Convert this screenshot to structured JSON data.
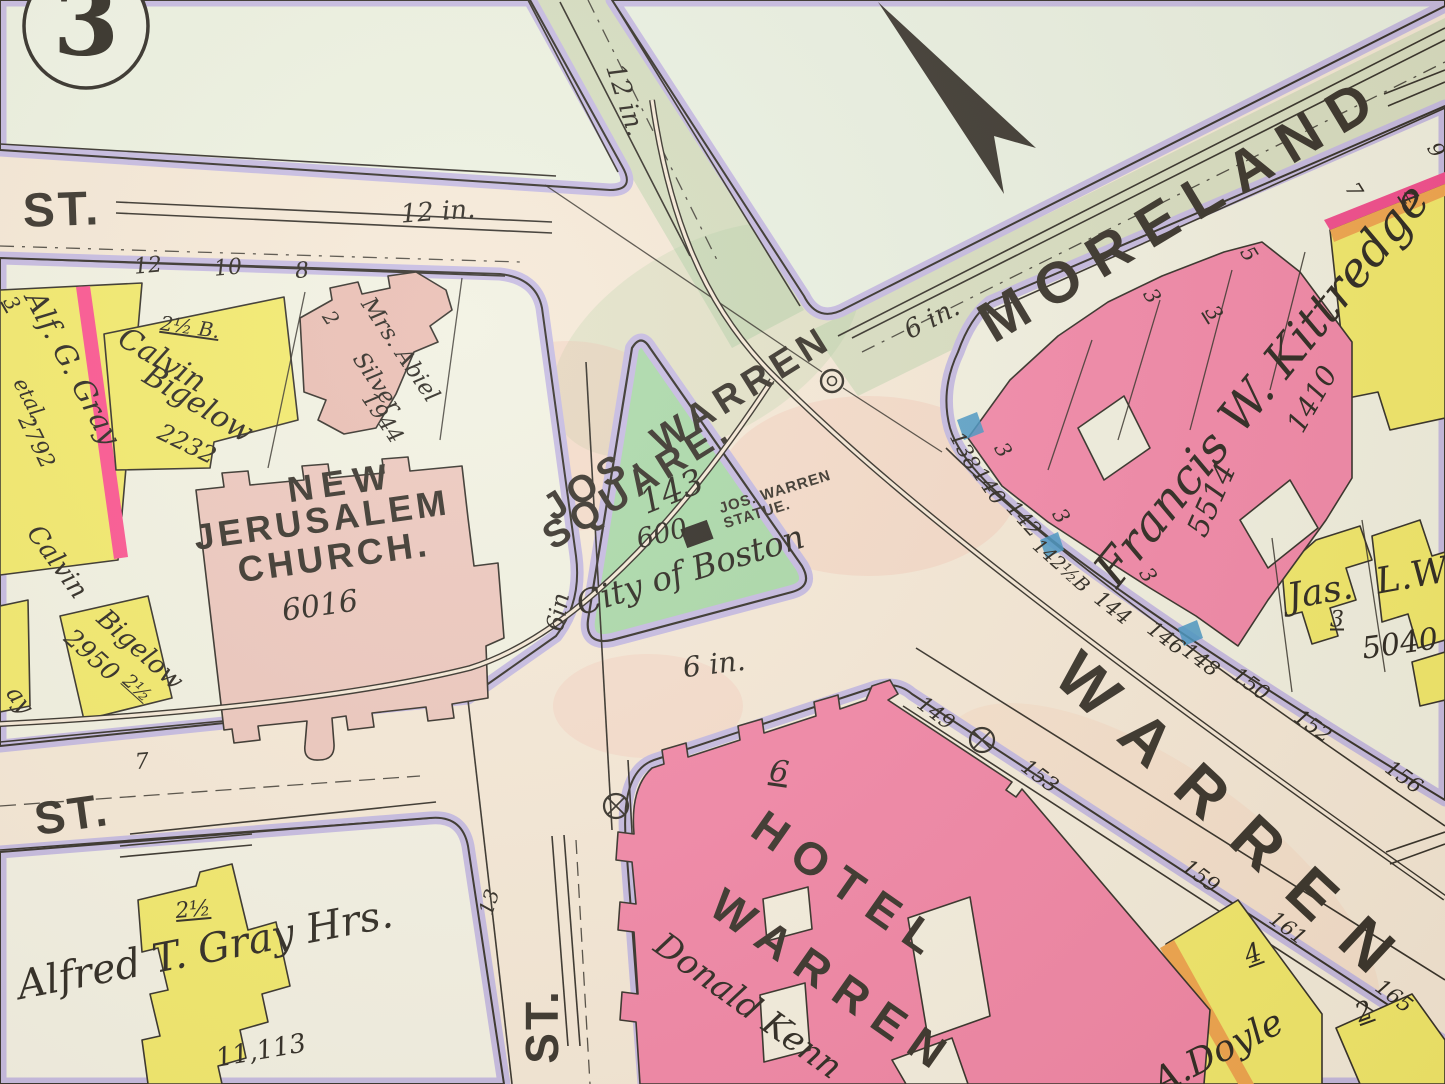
{
  "plate": {
    "number": "3"
  },
  "streets": {
    "st_top": "ST.",
    "st_left": "ST.",
    "st_bottom": "ST.",
    "moreland": "MORELAND",
    "warren": "WARREN"
  },
  "square": {
    "line1": "JOS. WARREN",
    "line2": "SQUARE.",
    "lot": "143",
    "area": "600",
    "statue_line1": "JOS. WARREN",
    "statue_line2": "STATUE.",
    "owner": "City of Boston"
  },
  "buildings": {
    "church_line1": "NEW",
    "church_line2": "JERUSALEM",
    "church_line3": "CHURCH.",
    "church_num": "6016",
    "hotel_line1": "HOTEL",
    "hotel_line2": "WARREN",
    "hotel_lot": "6",
    "hotel_owner": "Donald Kenn",
    "kittredge_name": "Francis W. Kittredge",
    "kittredge_num_a": "5514",
    "kittredge_num_b": "1410",
    "jas_name": "Jas.",
    "jas_name2": "L.W",
    "jas_lot": "3",
    "jas_num": "5040",
    "doyle_name": "A.Doyle",
    "doyle_lot": "4",
    "doyle2_lot": "2",
    "gray1_name": "Alf. G. Gray",
    "gray1_etal": "etal.",
    "gray1_num": "2792",
    "gray1_lot": "3",
    "bigelow1_first": "Calvin",
    "bigelow1_last": "Bigelow",
    "bigelow1_num": "2232",
    "bigelow1_size": "2½ B.",
    "silver_prefix": "2",
    "silver_line1": "Mrs. Abiel",
    "silver_line2": "Silver",
    "silver_num": "1944",
    "bigelow2_first": "Calvin",
    "bigelow2_last": "Bigelow",
    "bigelow2_num": "2950",
    "bigelow2_size": "2½",
    "gray2_name": "Alfred T. Gray Hrs.",
    "gray2_size": "2½",
    "gray2_num": "11,113",
    "fragment_left": "ay"
  },
  "pipes": {
    "main12_top": "12 in.",
    "main12_diag": "12 in.",
    "main6_moreland": "6 in.",
    "main6_square": "6 in.",
    "main6_vertical": "6in"
  },
  "house_numbers": {
    "n12": "12",
    "n10": "10",
    "n8": "8",
    "n7": "7",
    "n13": "13",
    "m3a": "3",
    "m3b": "3",
    "m5": "5",
    "m7": "7",
    "m4": "4",
    "m9": "9",
    "k3a": "3",
    "k3b": "3",
    "k3c": "3",
    "w138": "138",
    "w140": "140",
    "w142": "142",
    "w142h": "142½B",
    "w144": "144",
    "w146": "146",
    "w148": "148",
    "w150": "150",
    "w152": "152",
    "w156": "156",
    "w149": "149",
    "w153": "153",
    "w159": "159",
    "w161": "161",
    "w165": "165"
  }
}
